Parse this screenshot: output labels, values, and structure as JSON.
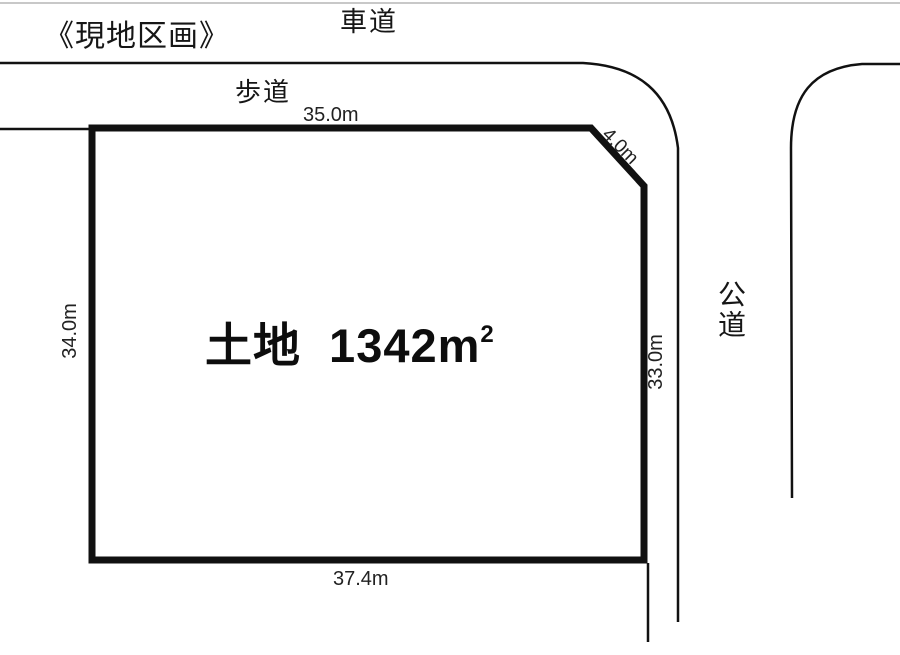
{
  "page": {
    "title": "《現地区画》"
  },
  "labels": {
    "roadway": "車道",
    "sidewalk": "歩道",
    "public_road": "公道"
  },
  "plot": {
    "area_text": "土地 1342m",
    "area_exponent": "2",
    "dimensions": {
      "top": "35.0m",
      "corner": "4.0m",
      "left": "34.0m",
      "right": "33.0m",
      "bottom": "37.4m"
    }
  },
  "colors": {
    "line": "#111111",
    "background": "#ffffff",
    "faint_top_edge": "#c8c8c8"
  }
}
